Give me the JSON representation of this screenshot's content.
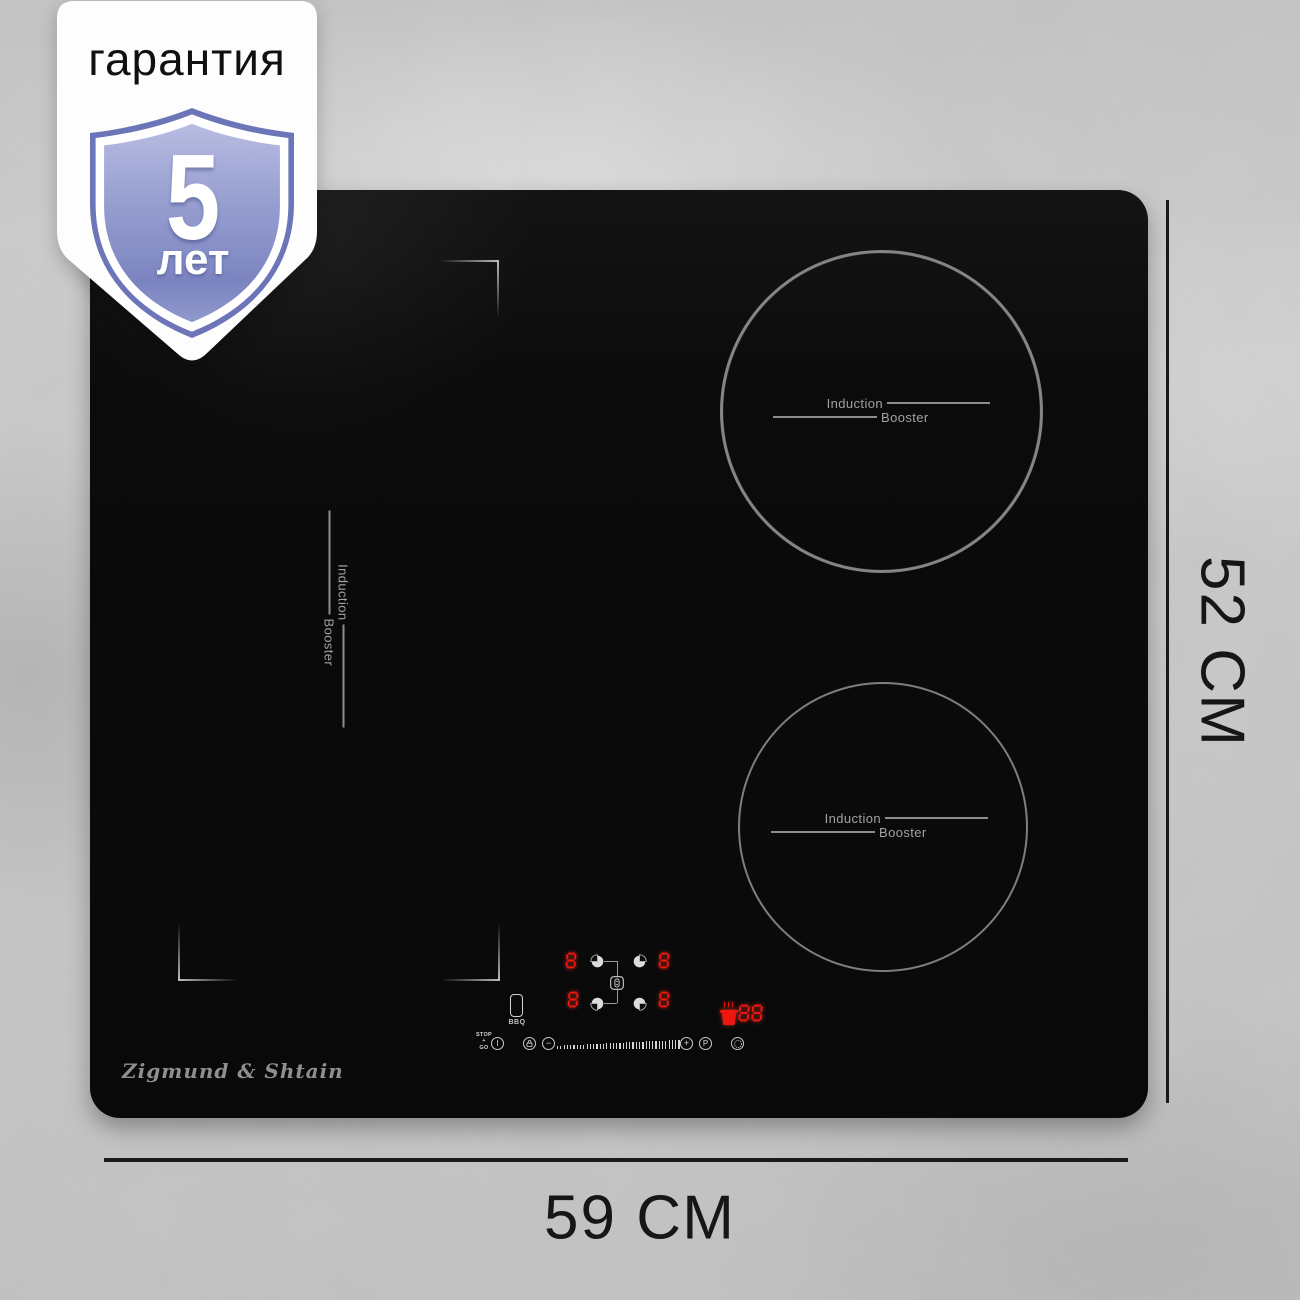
{
  "badge": {
    "title": "гарантия",
    "years": "5",
    "unit": "лет"
  },
  "brand": {
    "logo": "Zigmund & Shtain"
  },
  "dimensions": {
    "height_label": "52 СМ",
    "width_label": "59 СМ"
  },
  "zones": {
    "top_right": {
      "induction": "Induction",
      "booster": "Booster"
    },
    "bottom_right": {
      "induction": "Induction",
      "booster": "Booster"
    },
    "bridge_left": {
      "induction": "Induction",
      "booster": "Booster"
    }
  },
  "control_panel": {
    "stop": "STOP",
    "stop_plus": "+",
    "go": "GO",
    "power": "I",
    "minus": "−",
    "plus": "+",
    "booster": "P",
    "bbq": "BBQ",
    "heat_displays": [
      "8",
      "8",
      "8",
      "8"
    ],
    "warm_display": "88"
  },
  "colors": {
    "display_red": "#f01610",
    "glass_black": "#0b0b0b",
    "shield_blue": "#6b75b7",
    "background_gray": "#c9c9c9"
  },
  "icons": {
    "shield": "shield-icon",
    "burner_select": "burner-select-pie-icon",
    "bridge": "bridge-zone-icon",
    "bbq": "bbq-plate-icon",
    "power": "power-icon",
    "lock": "lock-icon",
    "timer": "timer-icon",
    "warm_pot": "pot-steam-icon"
  }
}
